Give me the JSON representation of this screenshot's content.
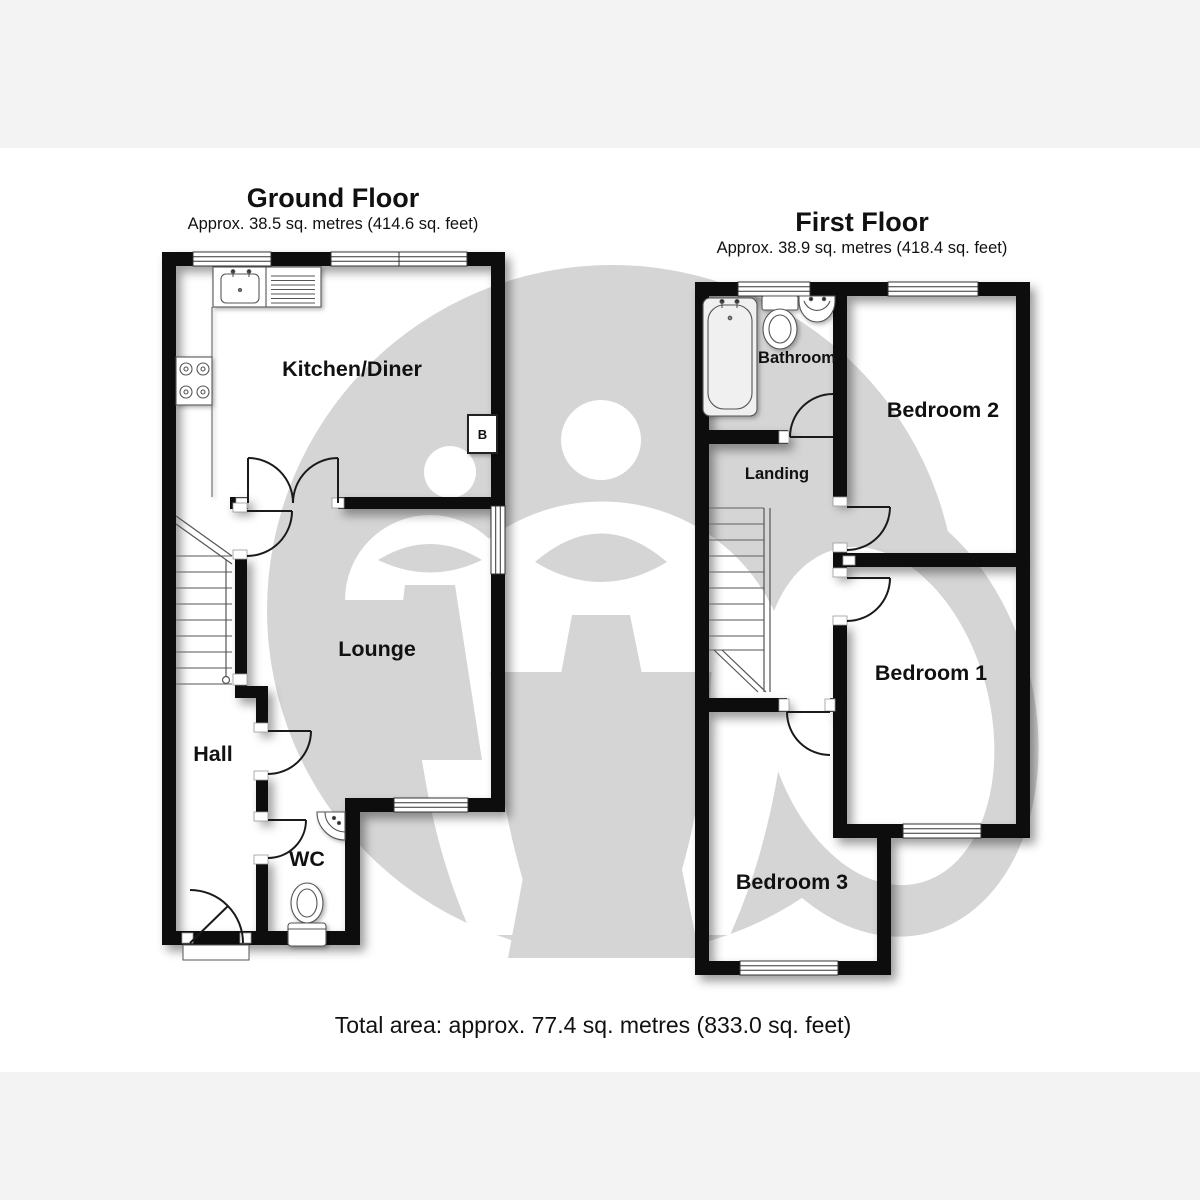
{
  "ground_floor": {
    "title": "Ground Floor",
    "area": "Approx. 38.5 sq. metres (414.6 sq. feet)",
    "rooms": {
      "kitchen": "Kitchen/Diner",
      "lounge": "Lounge",
      "hall": "Hall",
      "wc": "WC"
    },
    "boiler_label": "B"
  },
  "first_floor": {
    "title": "First Floor",
    "area": "Approx. 38.9 sq. metres (418.4 sq. feet)",
    "rooms": {
      "bathroom": "Bathroom",
      "landing": "Landing",
      "bedroom1": "Bedroom 1",
      "bedroom2": "Bedroom 2",
      "bedroom3": "Bedroom 3"
    }
  },
  "total_area": "Total area: approx. 77.4 sq. metres (833.0 sq. feet)",
  "colors": {
    "wall": "#0d0d0d",
    "floor": "#ffffff",
    "watermark_gray": "#d5d5d5",
    "page_band": "#f3f3f3",
    "fixture_stroke": "#555555"
  }
}
